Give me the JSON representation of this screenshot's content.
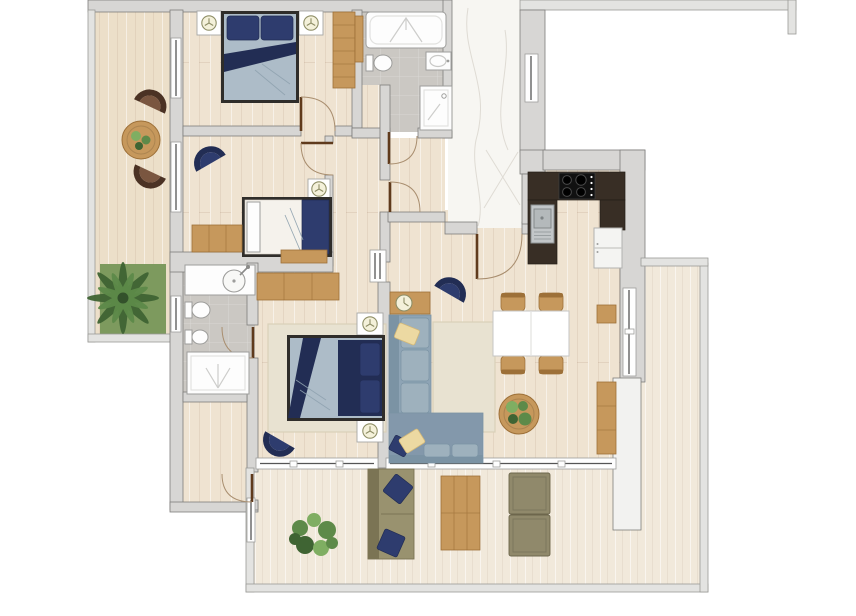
{
  "meta": {
    "description": "Top-down 2D rendered floor plan of a three-bedroom apartment with two bathrooms, open kitchen, living-dining room, two balconies and a large L-shaped terrace. No text labels are rendered on the plan.",
    "image_type": "apartment-floor-plan-render",
    "canvas": "856x616"
  },
  "palette": {
    "bg": "#ffffff",
    "wall_fill": "#d7d6d4",
    "wall_stroke": "#7e7d7b",
    "outer_wall_fill": "#e3e3e1",
    "outer_wall_stroke": "#9a9997",
    "white_partition": "#f2f2f0",
    "wood_floor": "#efe3d1",
    "terrace_floor": "#f1e9db",
    "balcony_floor": "#ecdfc9",
    "marble": "#f7f6f2",
    "marble_vein": "#dbd8d0",
    "tile": "#cbc8c3",
    "wood_furniture": "#c6985c",
    "wood_furniture_dark": "#9d7038",
    "navy": "#2e3c6e",
    "navy_dark": "#222d54",
    "duvet": "#adbcc8",
    "duvet_line": "#8fa2af",
    "sheet": "#f5f2ec",
    "bed_frame": "#2f2d2a",
    "sofa_body": "#8ea4b5",
    "sofa_back": "#7b93a4",
    "sofa_cushion": "#9eb1bd",
    "chaise": "#8398ab",
    "pillow_yellow": "#ecd9a2",
    "pillow_yellow_dark": "#d3b878",
    "rug": "#e8e2d1",
    "rug_stroke": "#d9d0b9",
    "olive": "#99926f",
    "olive_dark": "#7b7454",
    "pouf": "#90896b",
    "pouf_dark": "#6d664c",
    "brown_chair": "#7a5640",
    "brown_chair_rim": "#4b3224",
    "counter": "#382e25",
    "stove": "#111111",
    "sink_gray": "#c2c6c8",
    "fixture_white": "#fdfdfd",
    "fixture_stroke": "#9d9d9b",
    "door_leaf": "#5f3a1c",
    "door_arc": "#a98e6f",
    "window_fill": "#fefefe",
    "window_line": "#555555",
    "plant": "#5d8a49",
    "plant_dark": "#3f6433",
    "plant_light": "#7fae62",
    "grass": "#7d9a5e",
    "lamp_fill": "#f4f1da",
    "lamp_stroke": "#8e8e66"
  },
  "rooms": [
    {
      "id": "balcony-left",
      "kind": "balcony with two lounge chairs and round table"
    },
    {
      "id": "bedroom-1",
      "kind": "bedroom with double bed, two nightstands, wardrobe"
    },
    {
      "id": "bedroom-2",
      "kind": "bedroom with single bed, armchair, wardrobe, bench"
    },
    {
      "id": "bathroom-1",
      "kind": "bathroom with bathtub, toilet, sink, shower"
    },
    {
      "id": "entry-hall",
      "kind": "marble-floored entrance hallway"
    },
    {
      "id": "corridor",
      "kind": "internal corridor"
    },
    {
      "id": "storage-room",
      "kind": "small storage room"
    },
    {
      "id": "kitchen",
      "kind": "open kitchen with stove, sink, fridge"
    },
    {
      "id": "living-dining-room",
      "kind": "living room with corner sofa, dining table, coffee table, sideboard"
    },
    {
      "id": "master-bedroom",
      "kind": "master bedroom with double bed, wardrobe, armchair"
    },
    {
      "id": "bathroom-2",
      "kind": "en-suite bathroom with vanity, toilet, bidet, shower"
    },
    {
      "id": "dressing-room",
      "kind": "dressing / utility room"
    },
    {
      "id": "terrace",
      "kind": "large L-shaped terrace with outdoor furniture"
    }
  ],
  "inventory": {
    "double_beds": 2,
    "single_beds": 1,
    "wardrobes": 3,
    "nightstands_with_lamps": 5,
    "navy_armchairs": 3,
    "brown_balcony_chairs": 2,
    "corner_sofa": 1,
    "dining_chairs": 4,
    "dining_table": 1,
    "round_coffee_tables": 2,
    "side_table_with_clock": 1,
    "sideboard": 1,
    "wall_shelf": 1,
    "outdoor_sofa": 1,
    "outdoor_poufs": 2,
    "outdoor_wood_lounger": 1,
    "potted_plants": 4,
    "palm_tree": 1,
    "bathtub": 1,
    "showers": 2,
    "toilets": 3,
    "bidet": 1,
    "bathroom_sinks": 3,
    "stove_burners": 4,
    "kitchen_sink": 1,
    "fridge": 1
  }
}
